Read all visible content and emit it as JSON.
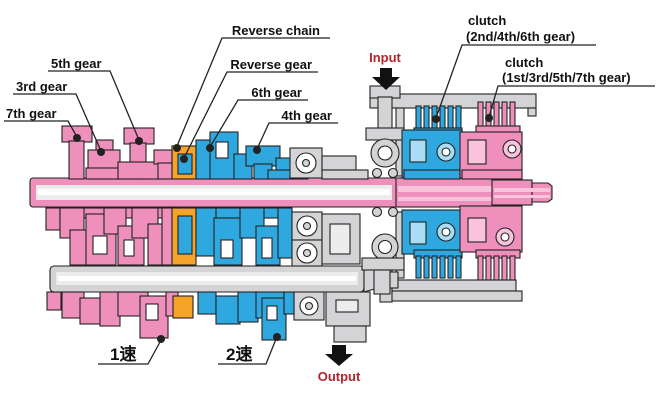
{
  "labels": {
    "gear5": "5th gear",
    "gear3": "3rd gear",
    "gear7": "7th gear",
    "reverse_chain": "Reverse chain",
    "reverse_gear": "Reverse gear",
    "gear6": "6th gear",
    "gear4": "4th gear",
    "clutch_even_line1": "clutch",
    "clutch_even_line2": "(2nd/4th/6th gear)",
    "clutch_odd_line1": "clutch",
    "clutch_odd_line2": "(1st/3rd/5th/7th gear)",
    "input": "Input",
    "output": "Output",
    "speed1": "1速",
    "speed2": "2速"
  },
  "colors": {
    "pink": "#EF8FBB",
    "pink_light": "#F8C3DB",
    "blue": "#2FA8DF",
    "blue_light": "#A9DDF3",
    "orange": "#F4A428",
    "gray": "#D4D4D6",
    "gray_light": "#ECECEC",
    "line": "#222222",
    "text": "#111111",
    "red": "#B5232B",
    "background": "#FFFFFF"
  }
}
